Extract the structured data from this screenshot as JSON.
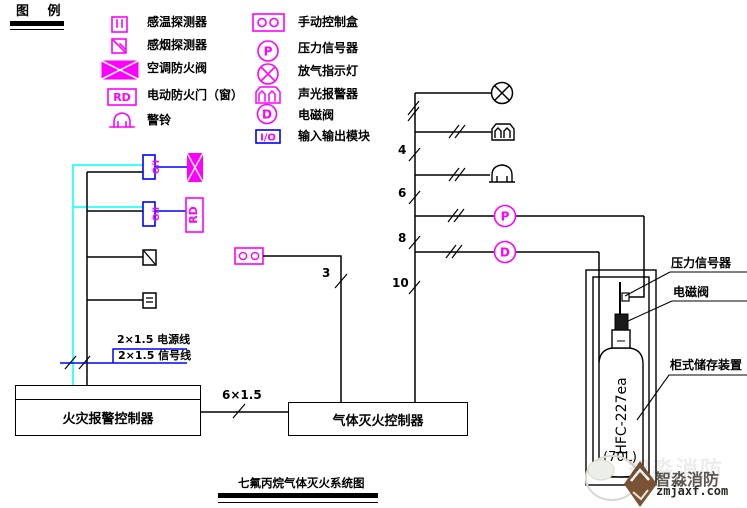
{
  "legend": {
    "title": "图 例",
    "items_left": [
      {
        "label": "感温探测器"
      },
      {
        "label": "感烟探测器"
      },
      {
        "label": "空调防火阀"
      },
      {
        "label": "电动防火门（窗）"
      },
      {
        "label": "警铃"
      }
    ],
    "items_right": [
      {
        "label": "手动控制盒"
      },
      {
        "label": "压力信号器"
      },
      {
        "label": "放气指示灯"
      },
      {
        "label": "声光报警器"
      },
      {
        "label": "电磁阀"
      },
      {
        "label": "输入输出模块"
      }
    ]
  },
  "symbols": {
    "io": "I/O",
    "rd": "RD",
    "pressure": "P",
    "solenoid": "D"
  },
  "labels": {
    "power_line": "2×1.5 电源线",
    "signal_line": "2×1.5 信号线",
    "bus": "6×1.5",
    "manual_count": "3",
    "count_4": "4",
    "count_6": "6",
    "count_8": "8",
    "count_10": "10"
  },
  "panels": {
    "fire_alarm_controller": "火灾报警控制器",
    "gas_extinguishing_controller": "气体灭火控制器"
  },
  "storage": {
    "cylinder_model": "HFC-227ea",
    "cylinder_capacity": "(70L)",
    "pressure_signal_label": "压力信号器",
    "solenoid_label": "电磁阀",
    "cabinet_label": "柜式储存装置"
  },
  "title": "七氟丙烷气体灭火系统图",
  "watermark": {
    "brand": "智淼消防",
    "site": "zmjaxf.com"
  },
  "colors": {
    "magenta": "#ff00ff",
    "blue": "#0000ff",
    "cyan": "#00ffff",
    "black": "#000000",
    "wm_brown": "#7a5334"
  }
}
